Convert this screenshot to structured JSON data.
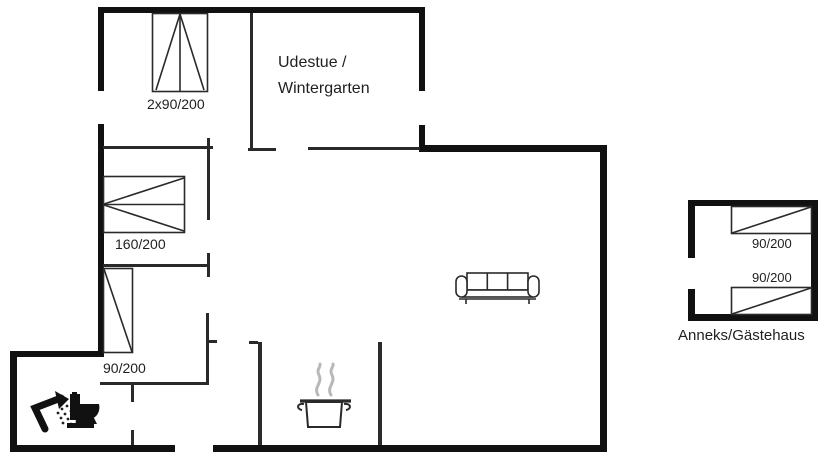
{
  "plan": {
    "type": "floor-plan",
    "background": "#ffffff",
    "wall_color": "#111111",
    "thin_wall_color": "#2a2a2a",
    "furniture_line_color": "#2a2a2a",
    "steam_color": "#b8b8b8",
    "text_color": "#1f1f1f"
  },
  "rooms": {
    "conservatory": {
      "line1": "Udestue /",
      "line2": "Wintergarten"
    },
    "annex": {
      "label": "Anneks/Gästehaus"
    }
  },
  "beds": {
    "bedroom1_double": {
      "label": "2x90/200"
    },
    "bedroom2_double": {
      "label": "160/200"
    },
    "bedroom3_single": {
      "label": "90/200"
    },
    "annex_bed_top": {
      "label": "90/200"
    },
    "annex_bed_bottom": {
      "label": "90/200"
    }
  },
  "icons": {
    "sofa": "sofa-icon",
    "pot": "cooking-pot-icon",
    "steam": "steam-icon",
    "shower": "shower-icon",
    "toilet": "toilet-icon"
  }
}
